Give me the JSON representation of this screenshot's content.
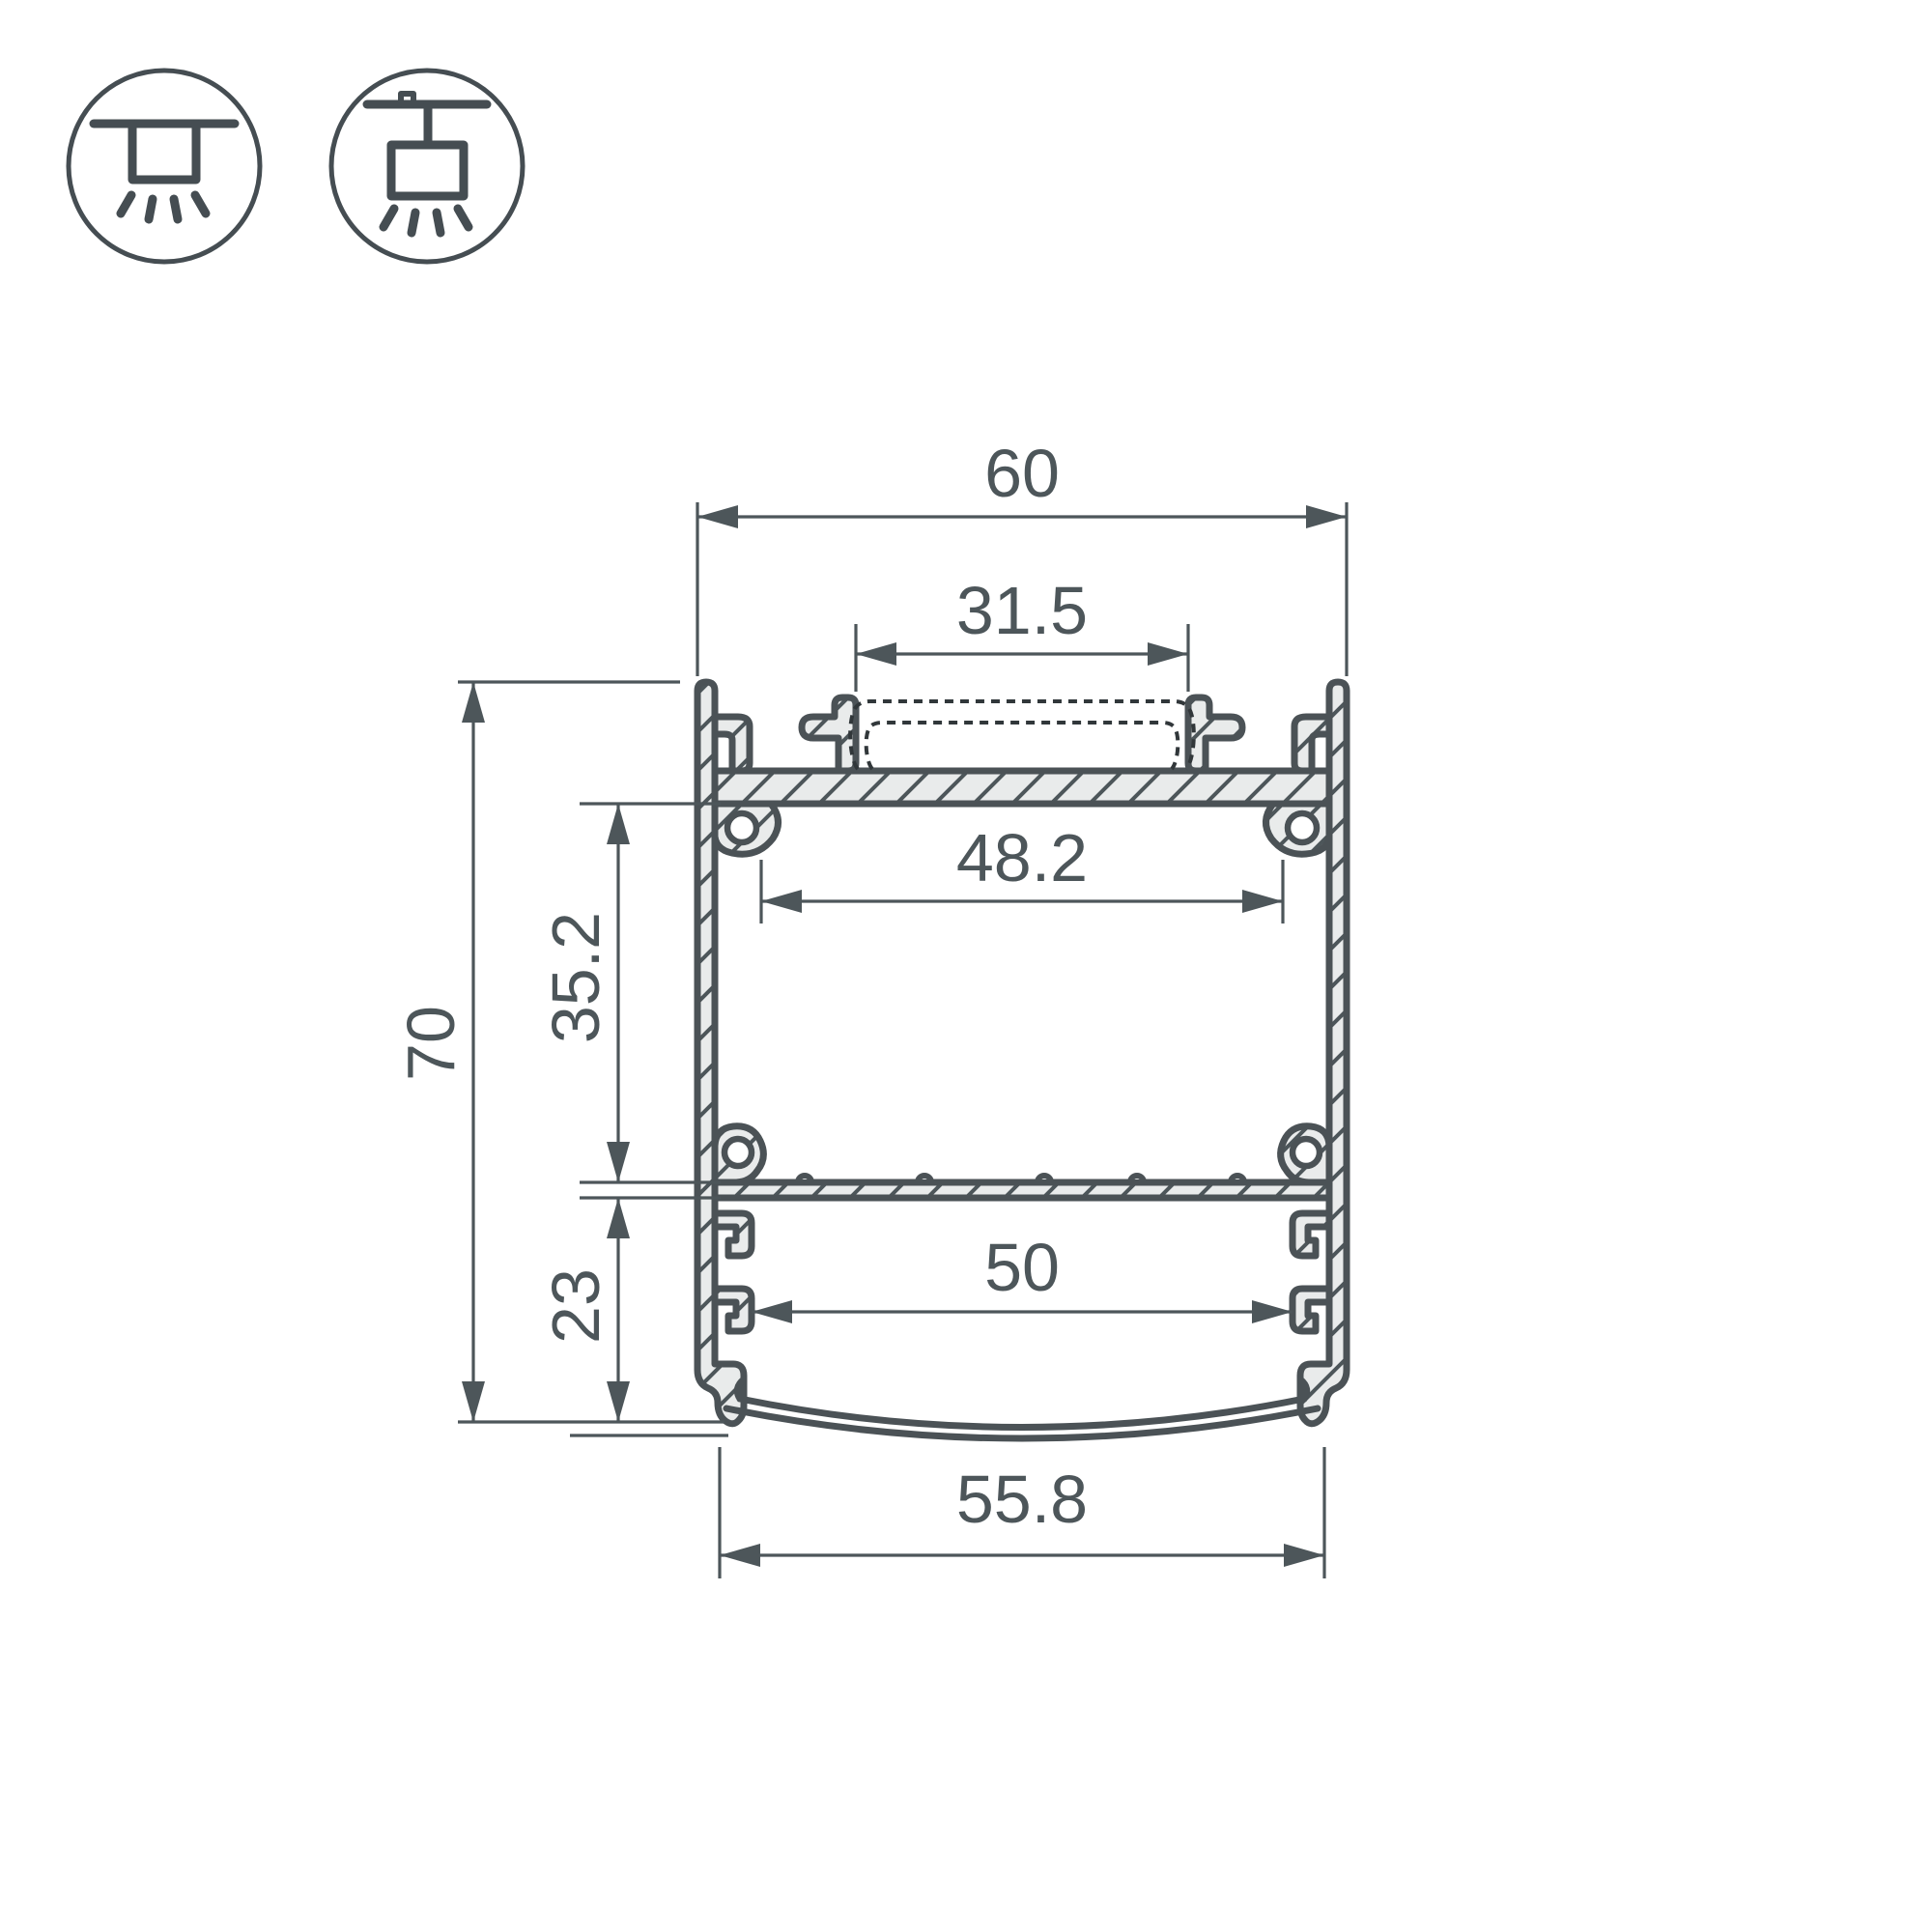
{
  "drawing": {
    "type": "led-profile-cross-section",
    "dimensions": {
      "overall_width": "60",
      "top_channel_width": "31.5",
      "inner_width": "48.2",
      "upper_cavity_height": "35.2",
      "overall_height": "70",
      "lower_cavity_height": "23",
      "diffuser_opening_width": "50",
      "bottom_width": "55.8"
    },
    "colors": {
      "line": "#4d565a",
      "profile_fill": "#e9ebeb",
      "background": "#ffffff"
    }
  },
  "icons": [
    {
      "id": "surface-mount-light-icon",
      "meaning": "surface ceiling mounting"
    },
    {
      "id": "pendant-mount-light-icon",
      "meaning": "suspended pendant mounting"
    }
  ]
}
